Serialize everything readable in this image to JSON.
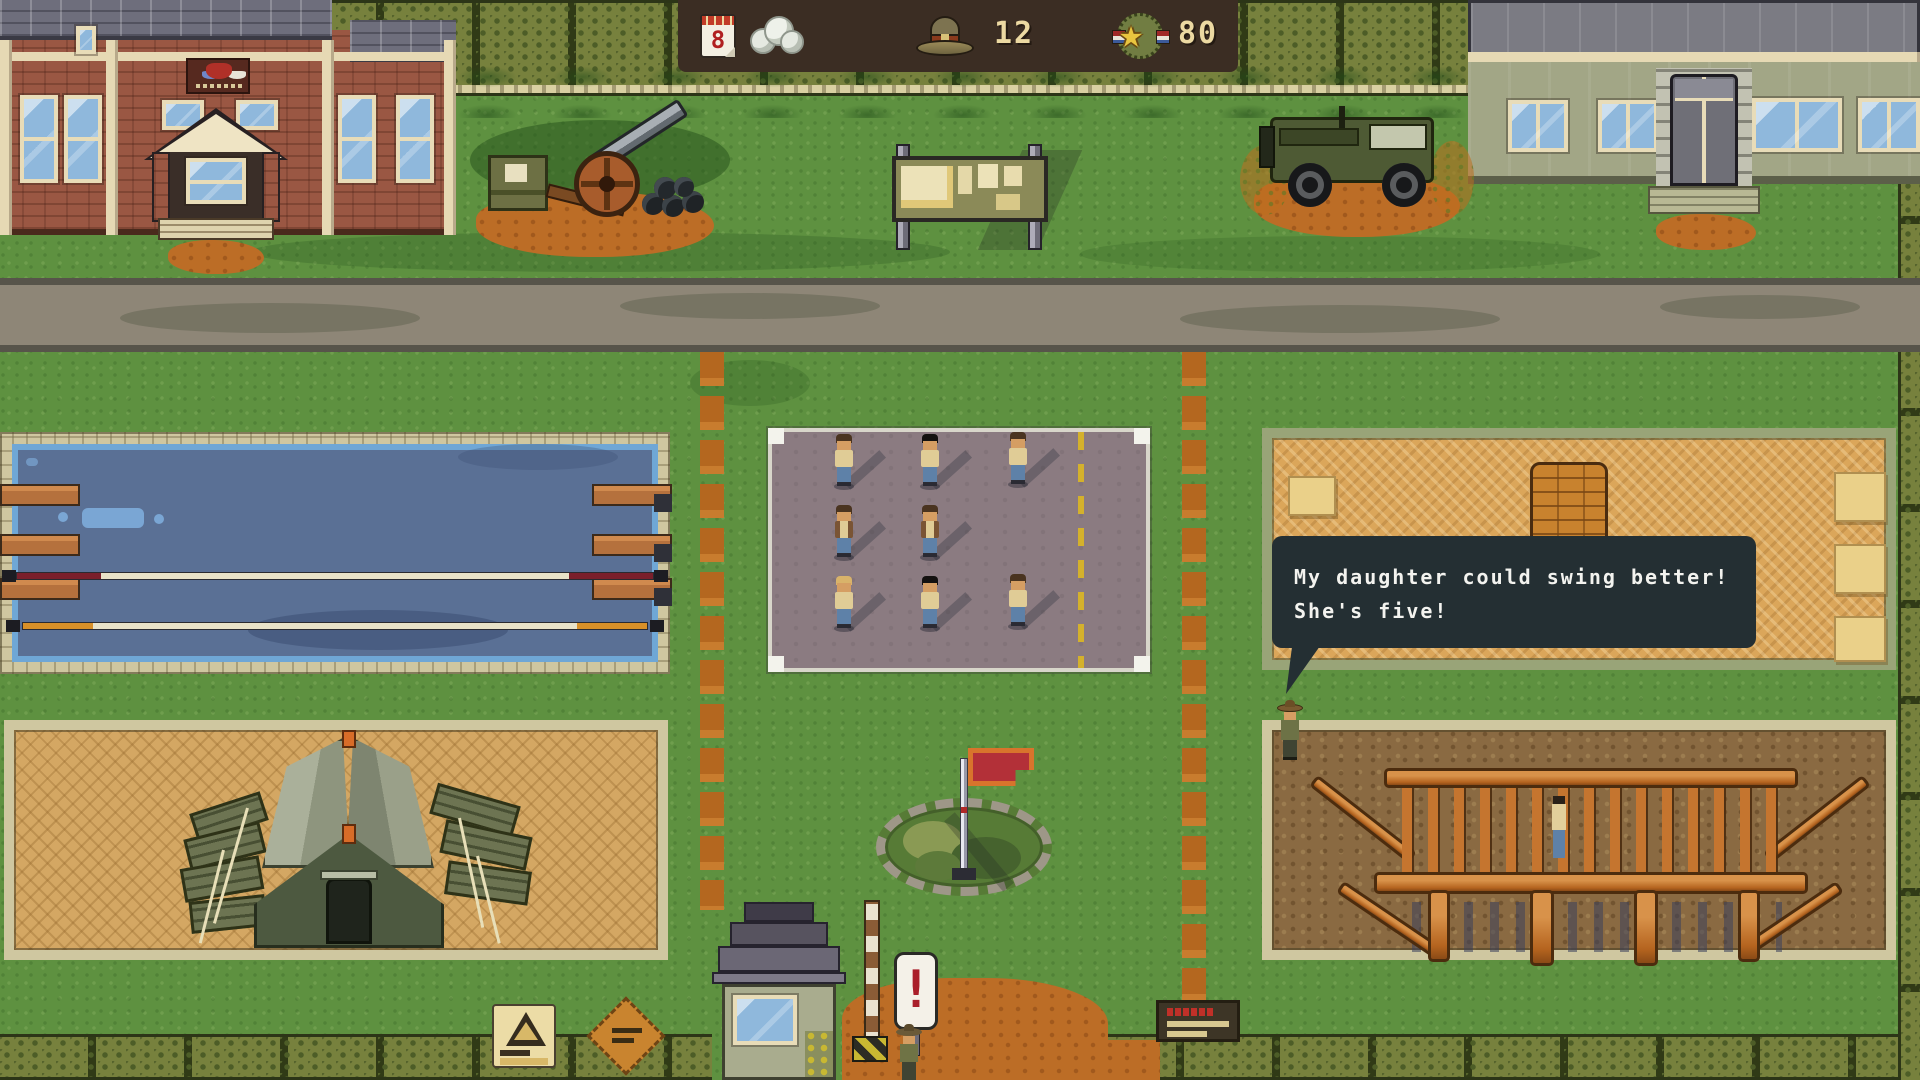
{
  "hud": {
    "day_value": "8",
    "recruits_count": "12",
    "merit_count": "80",
    "star_char": "★",
    "icons": {
      "day": "calendar-icon",
      "weather": "cloud-icon",
      "recruits": "campaign-hat-icon",
      "merit": "star-medal-icon"
    },
    "colors": {
      "background": "#3b2d23",
      "text": "#ecd9a2"
    }
  },
  "speech_bubble": {
    "line1": "My daughter could swing better!",
    "line2": "She's five!",
    "colors": {
      "background": "#242f33",
      "text": "#f3f3ef"
    }
  },
  "gate": {
    "exclamation_sign": "!"
  },
  "scene": {
    "colors": {
      "grass": "#5e9140",
      "road": "#8e8677",
      "dirt_trail": "#b4671f",
      "pool_water": "#5a7095",
      "drill_square": "#8b7b81",
      "sand_mats": "#dba65a",
      "tent_sand": "#d4a763",
      "bars_dirt": "#8a6a42",
      "wood": "#c5752f",
      "hq_brick": "#9a5743",
      "admin_wall": "#a2a686",
      "fence": "#77813d",
      "flag": "#b33038"
    }
  }
}
